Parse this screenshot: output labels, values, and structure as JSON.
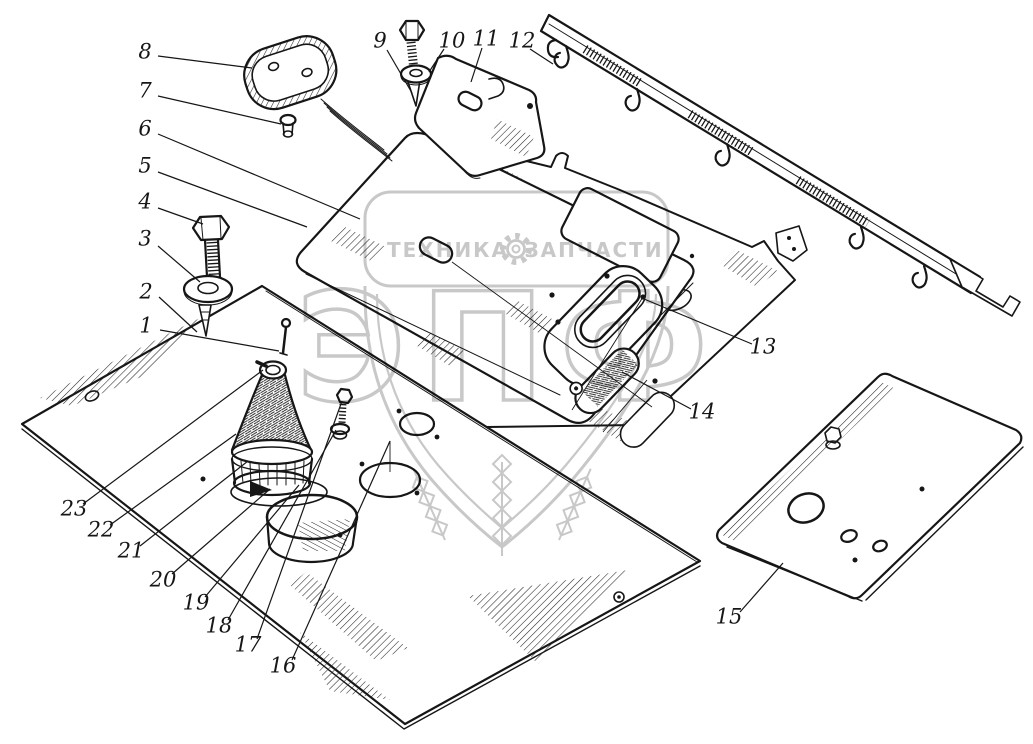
{
  "figure": {
    "type": "exploded-parts-diagram",
    "background": "#ffffff",
    "ink": "#161616"
  },
  "watermark": {
    "color": "#c3c3c3",
    "band_text_left": "ТЕХНИКА",
    "band_text_right": "ЗАПЧАСТИ",
    "gear_icon": "gear-icon",
    "emblem_letters": "ЭПФ"
  },
  "callouts": [
    {
      "label": "1",
      "x": 146,
      "y": 327,
      "leader": [
        160,
        330,
        279,
        351
      ]
    },
    {
      "label": "2",
      "x": 146,
      "y": 293,
      "leader": [
        159,
        297,
        197,
        332
      ]
    },
    {
      "label": "3",
      "x": 145,
      "y": 240,
      "leader": [
        158,
        246,
        200,
        282
      ]
    },
    {
      "label": "4",
      "x": 145,
      "y": 203,
      "leader": [
        158,
        208,
        203,
        224
      ]
    },
    {
      "label": "5",
      "x": 145,
      "y": 167,
      "leader": [
        158,
        172,
        307,
        227
      ]
    },
    {
      "label": "6",
      "x": 145,
      "y": 130,
      "leader": [
        158,
        134,
        360,
        219
      ]
    },
    {
      "label": "7",
      "x": 145,
      "y": 92,
      "leader": [
        158,
        96,
        281,
        124
      ]
    },
    {
      "label": "8",
      "x": 145,
      "y": 53,
      "leader": [
        158,
        56,
        252,
        68
      ]
    },
    {
      "label": "9",
      "x": 380,
      "y": 42,
      "leader": [
        387,
        50,
        412,
        93
      ]
    },
    {
      "label": "10",
      "x": 452,
      "y": 42,
      "leader": [
        444,
        49,
        429,
        72
      ]
    },
    {
      "label": "11",
      "x": 486,
      "y": 40,
      "leader": [
        482,
        48,
        471,
        82
      ]
    },
    {
      "label": "12",
      "x": 522,
      "y": 42,
      "leader": [
        530,
        49,
        553,
        64
      ]
    },
    {
      "label": "13",
      "x": 763,
      "y": 348,
      "leader": [
        752,
        344,
        644,
        299
      ]
    },
    {
      "label": "14",
      "x": 702,
      "y": 413,
      "leader": [
        691,
        409,
        622,
        372
      ]
    },
    {
      "label": "15",
      "x": 729,
      "y": 618,
      "leader": [
        740,
        612,
        783,
        563
      ]
    },
    {
      "label": "16",
      "x": 283,
      "y": 667,
      "leader": [
        292,
        660,
        390,
        441
      ]
    },
    {
      "label": "17",
      "x": 248,
      "y": 646,
      "leader": [
        257,
        639,
        342,
        401
      ]
    },
    {
      "label": "18",
      "x": 219,
      "y": 627,
      "leader": [
        228,
        620,
        336,
        430
      ]
    },
    {
      "label": "19",
      "x": 196,
      "y": 604,
      "leader": [
        205,
        597,
        299,
        485
      ]
    },
    {
      "label": "20",
      "x": 163,
      "y": 581,
      "leader": [
        172,
        574,
        270,
        489
      ]
    },
    {
      "label": "21",
      "x": 131,
      "y": 552,
      "leader": [
        140,
        546,
        248,
        461
      ]
    },
    {
      "label": "22",
      "x": 101,
      "y": 531,
      "leader": [
        110,
        525,
        236,
        434
      ]
    },
    {
      "label": "23",
      "x": 74,
      "y": 510,
      "leader": [
        83,
        504,
        263,
        370
      ]
    }
  ],
  "assembly_lines": [
    [
      390,
      441,
      390,
      472
    ],
    [
      452,
      262,
      652,
      407
    ],
    [
      643,
      297,
      572,
      410
    ],
    [
      647,
      380,
      603,
      432
    ]
  ]
}
